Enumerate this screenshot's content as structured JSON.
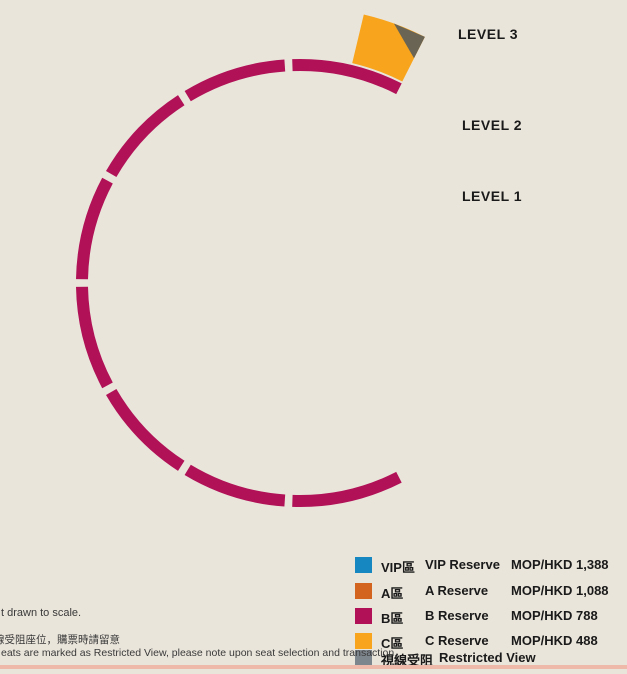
{
  "levels": [
    "LEVEL 3",
    "LEVEL 2",
    "LEVEL 1"
  ],
  "stage": {
    "label_cn": "舞台",
    "label_en": "STAGE"
  },
  "floor_upper": {
    "label_cn": "地面座位",
    "label_en": "FLOOR SEATS"
  },
  "floor_lower": {
    "label_cn": "地面座位",
    "label_en": "FLOOR SEATS"
  },
  "foh": {
    "label": "FOH"
  },
  "watermark": {
    "brand": "GALAXY",
    "sub": "ARENA",
    "cn": "銀河綜藝館"
  },
  "colors": {
    "bg": "#EAE5DB",
    "vip": "#1787C1",
    "a": "#D2641F",
    "b": "#B01157",
    "c": "#F8A51D",
    "restricted": "#46617B",
    "restricted_gray": "#8C8C8C",
    "legend_restricted": "#7E868D",
    "corner_c": "#6A6454",
    "corner_a": "#5E586A",
    "stage": "#F6CE97",
    "foh_box": "#55565A",
    "text_dark": "#1A1A1A",
    "bottom_bar": "#EFB9A9",
    "ribbon": "#6B685F"
  },
  "legend": [
    {
      "zone_cn": "VIP區",
      "zone_en": "VIP Reserve",
      "price": "MOP/HKD 1,388",
      "color": "vip"
    },
    {
      "zone_cn": "A區",
      "zone_en": "A Reserve",
      "price": "MOP/HKD 1,088",
      "color": "a"
    },
    {
      "zone_cn": "B區",
      "zone_en": "B Reserve",
      "price": "MOP/HKD 788",
      "color": "b"
    },
    {
      "zone_cn": "C區",
      "zone_en": "C Reserve",
      "price": "MOP/HKD 488",
      "color": "c"
    },
    {
      "zone_cn": "視線受阻",
      "zone_en": "Restricted View",
      "price": "",
      "color": "legend_restricted"
    }
  ],
  "notes": [
    "t drawn to scale.",
    "線受阻座位，購票時請留意",
    "eats are marked as Restricted View, please note upon seat selection and transaction."
  ],
  "arena": {
    "sections": [
      {
        "id": "302",
        "label": "302",
        "tier": "c",
        "corner": "start"
      },
      {
        "id": "303",
        "label": "303",
        "tier": "c"
      },
      {
        "id": "304",
        "label": "304",
        "tier": "c"
      },
      {
        "id": "305",
        "label": "305",
        "tier": "c"
      },
      {
        "id": "306",
        "label": "306",
        "tier": "c"
      },
      {
        "id": "307",
        "label": "307",
        "tier": "b",
        "outer_tier": "c"
      },
      {
        "id": "308",
        "label": "308",
        "tier": "b",
        "outer_tier": "c"
      },
      {
        "id": "309",
        "label": "309",
        "tier": "b",
        "outer_tier": "restricted_gray"
      },
      {
        "id": "310",
        "label": "310",
        "tier": "b",
        "outer_tier": "c"
      },
      {
        "id": "311",
        "label": "311",
        "tier": "b",
        "outer_tier": "c"
      },
      {
        "id": "312",
        "label": "312",
        "tier": "c"
      },
      {
        "id": "313",
        "label": "313",
        "tier": "c"
      },
      {
        "id": "314",
        "label": "314",
        "tier": "c"
      },
      {
        "id": "315",
        "label": "315",
        "tier": "c"
      },
      {
        "id": "316",
        "label": "316",
        "tier": "c",
        "corner": "end"
      },
      {
        "id": "203",
        "label": "203",
        "tier": "a",
        "outer_tier": "b",
        "corner": "start"
      },
      {
        "id": "204",
        "label": "204",
        "tier": "a",
        "outer_tier": "b"
      },
      {
        "id": "205",
        "label": "205",
        "tier": "a",
        "outer_tier": "b"
      },
      {
        "id": "206",
        "label": "206",
        "tier": "a",
        "outer_tier": "b"
      },
      {
        "id": "207",
        "label": "207",
        "tier": "a",
        "outer_tier": "b"
      },
      {
        "id": "208",
        "label": "208",
        "tier": "a"
      },
      {
        "id": "209",
        "label": "209",
        "tier": "a"
      },
      {
        "id": "210",
        "label": "210",
        "tier": "a"
      },
      {
        "id": "211",
        "label": "211",
        "tier": "a"
      },
      {
        "id": "212",
        "label": "212",
        "tier": "a"
      },
      {
        "id": "213",
        "label": "213",
        "tier": "a",
        "outer_tier": "b"
      },
      {
        "id": "214",
        "label": "214",
        "tier": "a",
        "outer_tier": "b"
      },
      {
        "id": "215",
        "label": "215",
        "tier": "a",
        "outer_tier": "b"
      },
      {
        "id": "216",
        "label": "216",
        "tier": "a",
        "outer_tier": "b"
      },
      {
        "id": "217",
        "label": "217",
        "tier": "a",
        "outer_tier": "b",
        "corner": "end"
      },
      {
        "id": "102",
        "label": "102",
        "tier": "vip",
        "outer_tier": "restricted"
      },
      {
        "id": "103",
        "label": "103",
        "tier": "vip"
      },
      {
        "id": "104",
        "label": "104",
        "tier": "vip",
        "outer_tier": "a"
      },
      {
        "id": "105",
        "label": "105",
        "tier": "vip",
        "outer_tier": "a"
      },
      {
        "id": "106",
        "label": "106",
        "tier": "a"
      },
      {
        "id": "107",
        "label": "107",
        "tier": "vip"
      },
      {
        "id": "108",
        "label": "",
        "tier": "restricted_gray"
      },
      {
        "id": "109",
        "label": "109",
        "tier": "vip"
      },
      {
        "id": "110",
        "label": "110",
        "tier": "a"
      },
      {
        "id": "111",
        "label": "111",
        "tier": "vip",
        "outer_tier": "a"
      },
      {
        "id": "112",
        "label": "112",
        "tier": "vip",
        "outer_tier": "a"
      },
      {
        "id": "113",
        "label": "113",
        "tier": "vip"
      },
      {
        "id": "114",
        "label": "114",
        "tier": "vip",
        "outer_tier": "restricted"
      }
    ]
  }
}
